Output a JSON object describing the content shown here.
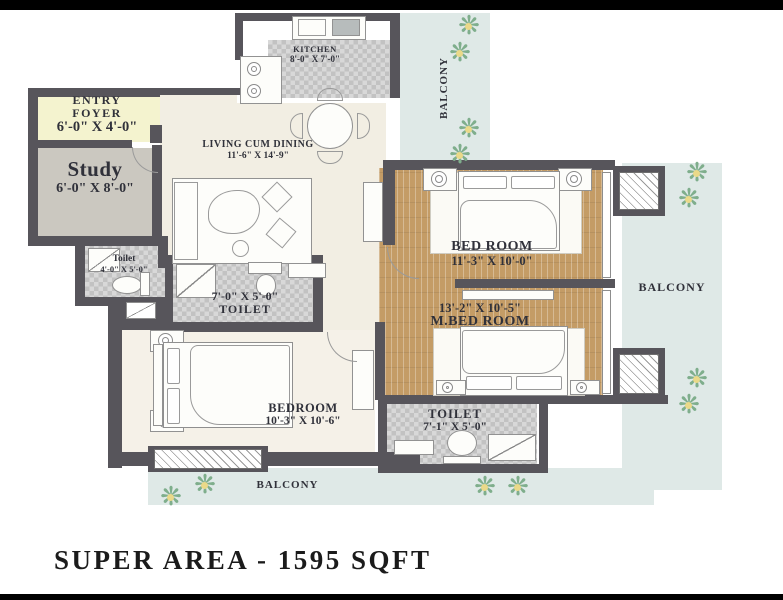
{
  "footer": {
    "super_area": "SUPER AREA - 1595 SQFT"
  },
  "rooms": {
    "kitchen": {
      "name": "KITCHEN",
      "dims": "8'-0\" X 7'-0\""
    },
    "entry_foyer": {
      "line1": "ENTRY",
      "line2": "FOYER",
      "dims": "6'-0\" X 4'-0\""
    },
    "study": {
      "name": "Study",
      "dims": "6'-0\" X 8'-0\""
    },
    "toilet_small": {
      "name": "Toilet",
      "dims": "4'-0\" X 5'-0\""
    },
    "living": {
      "name": "LIVING CUM DINING",
      "dims": "11'-6\" X 14'-9\""
    },
    "toilet_common": {
      "name": "TOILET",
      "dims": "7'-0\" X 5'-0\""
    },
    "bed_room": {
      "name": "BED ROOM",
      "dims": "11'-3\" X 10'-0\""
    },
    "master_bed_room": {
      "name": "M.BED ROOM",
      "dims": "13'-2\" X 10'-5\""
    },
    "bedroom": {
      "name": "BEDROOM",
      "dims": "10'-3\" X 10'-6\""
    },
    "toilet_master": {
      "name": "TOILET",
      "dims": "7'-1\" X 5'-0\""
    }
  },
  "balconies": {
    "top": "BALCONY",
    "right": "BALCONY",
    "bottom": "BALCONY"
  },
  "icons": {
    "flower": "❋"
  },
  "colors": {
    "wall": "#57555b",
    "balcony": "#dfe9e7",
    "wood": "#c49c66",
    "foyer": "#f4f3cf",
    "living": "#f2eee3",
    "tile": "#cdcdcd"
  }
}
